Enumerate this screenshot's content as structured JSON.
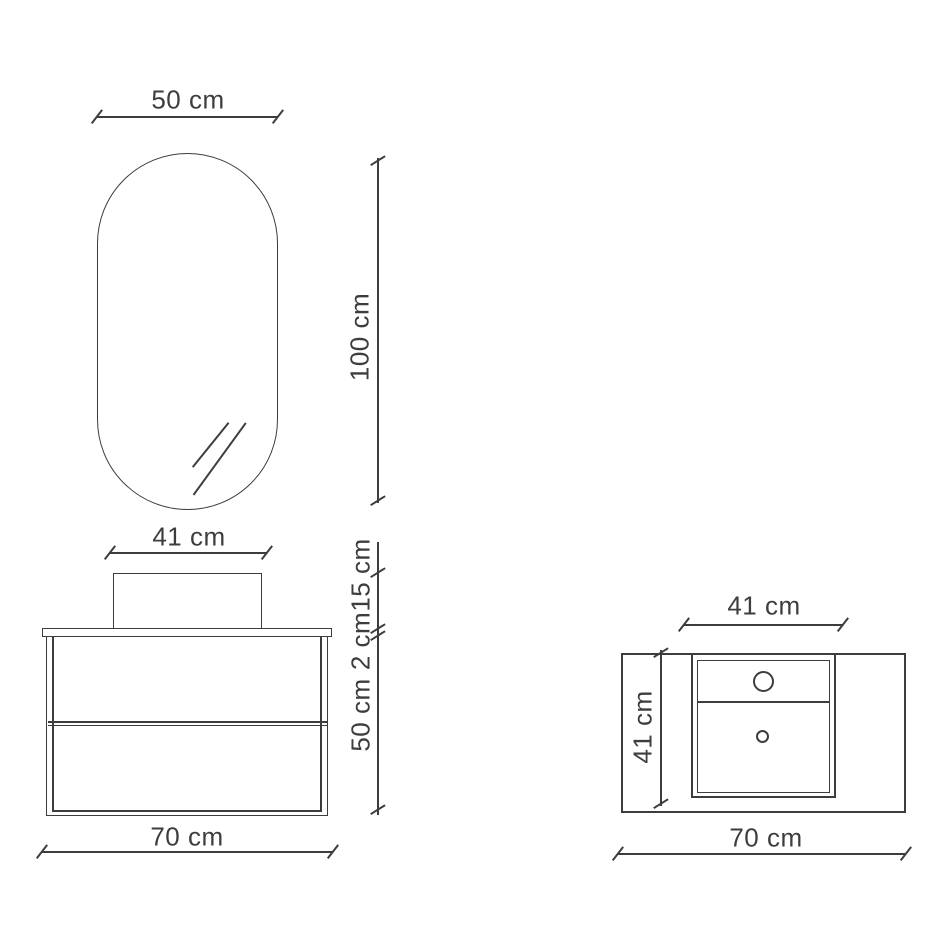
{
  "page": {
    "ink_color": "#3d3d3d",
    "background_color": "#ffffff"
  },
  "front_view": {
    "mirror_width": "50 cm",
    "mirror_height": "100 cm",
    "basin_width": "41 cm",
    "basin_height": "15 cm",
    "countertop_thickness": "2 cm",
    "cabinet_height": "50 cm",
    "total_width": "70 cm"
  },
  "top_view": {
    "basin_width": "41 cm",
    "depth": "41 cm",
    "total_width": "70 cm"
  }
}
